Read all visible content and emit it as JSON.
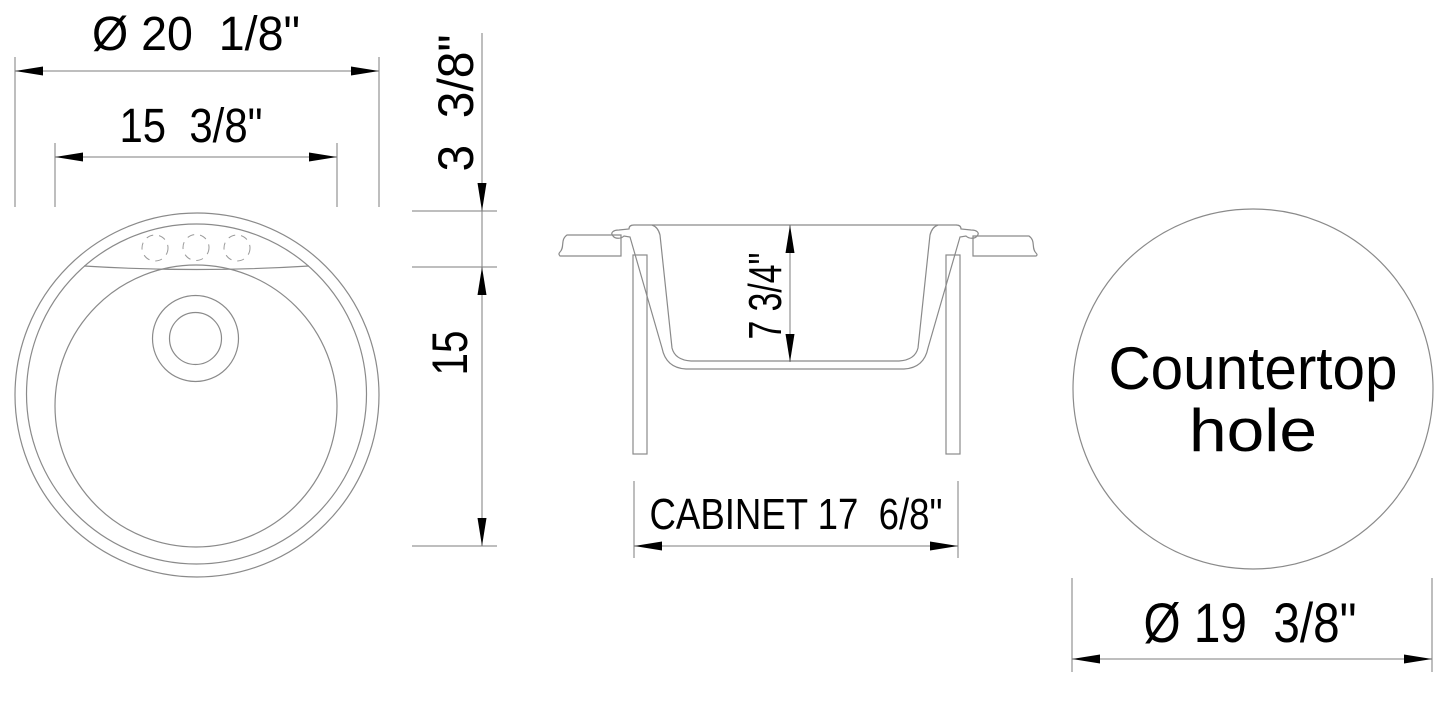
{
  "drawing_title": "Round sink technical drawing",
  "plan_view": {
    "dim_outer_diameter": "Ø 20  1/8\"",
    "dim_bowl_width": "15  3/8\"",
    "dim_deck_depth": "3  3/8\"",
    "dim_bowl_length": "15"
  },
  "section_view": {
    "dim_bowl_depth": "7 3/4\"",
    "dim_cabinet_width": "CABINET 17  6/8\""
  },
  "countertop_view": {
    "label_line1": "Countertop",
    "label_line2": "hole",
    "dim_hole_diameter": "Ø 19  3/8\""
  },
  "colors": {
    "background": "#ffffff",
    "geometry_line": "#8a8a8a",
    "dimension_line": "#7d7d7d",
    "ink": "#000000"
  }
}
